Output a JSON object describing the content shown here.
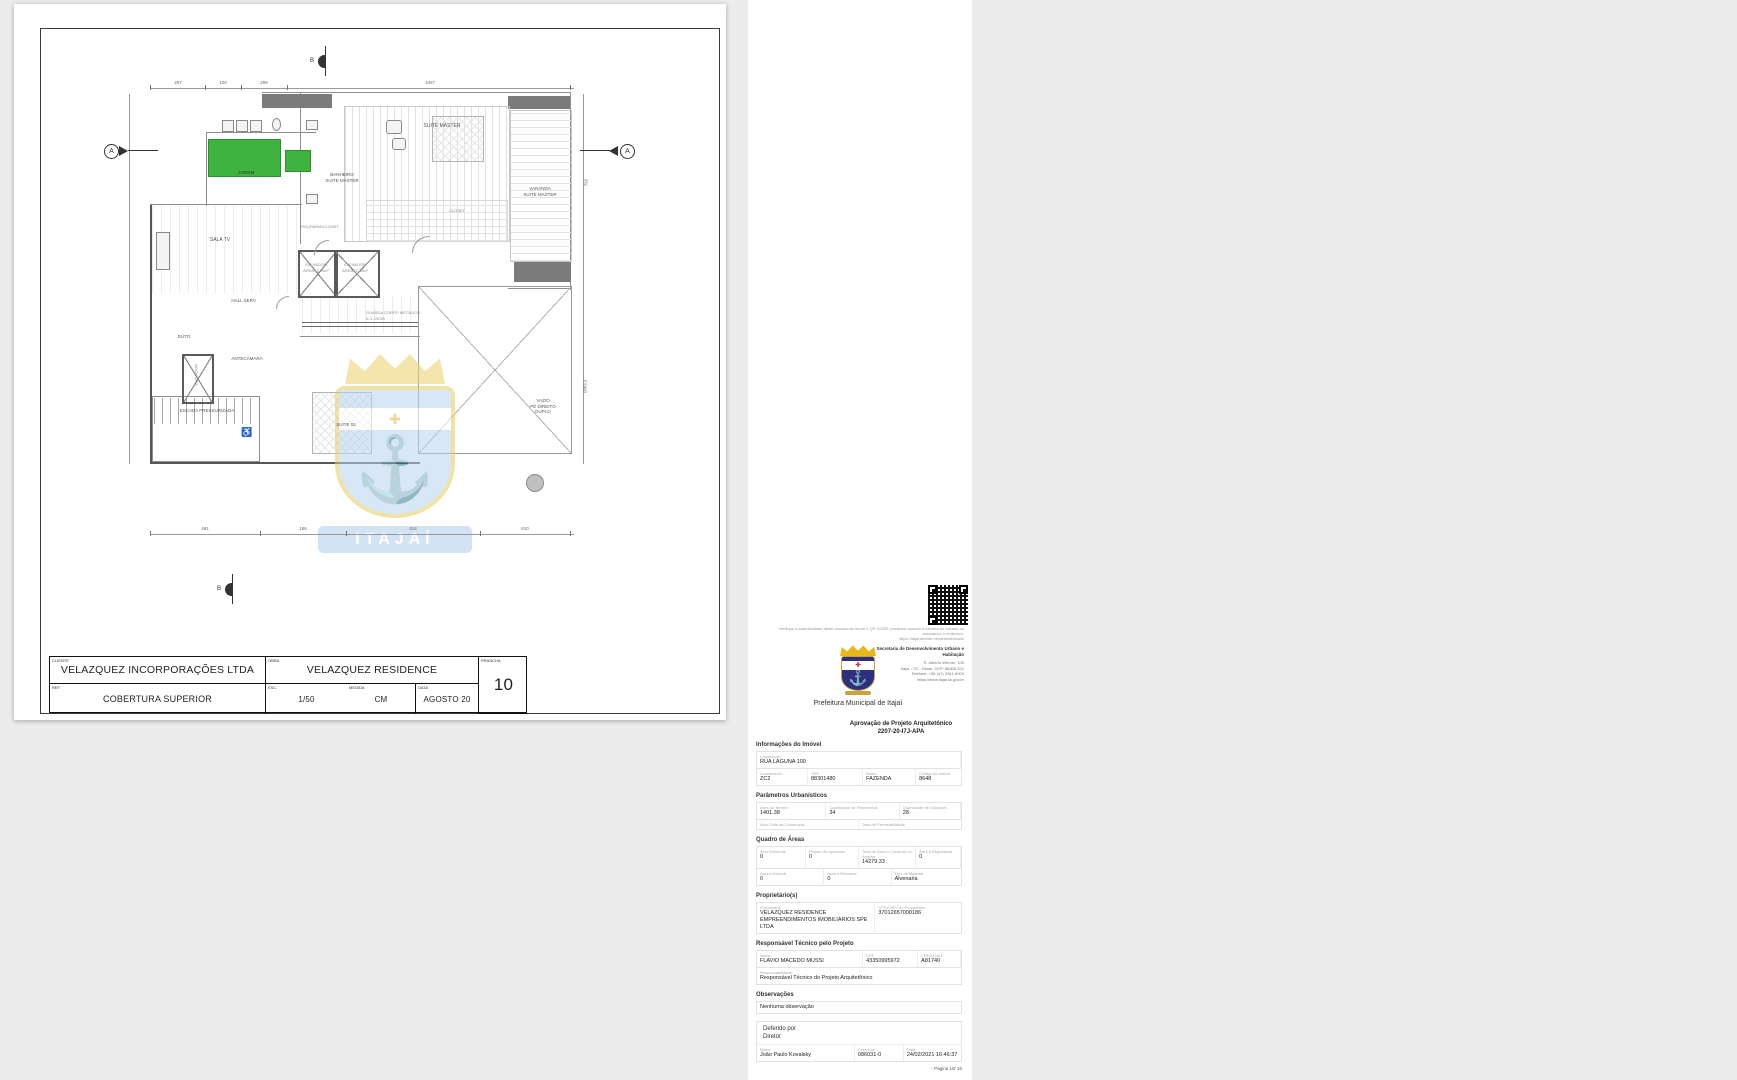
{
  "titleblock": {
    "cliente_label": "CLIENTE",
    "cliente": "VELAZQUEZ INCORPORAÇÕES LTDA",
    "obra_label": "OBRA",
    "obra": "VELAZQUEZ RESIDENCE",
    "ref_label": "REF.",
    "ref": "COBERTURA SUPERIOR",
    "escala_label": "ESC.",
    "escala": "1/50",
    "medida_label": "MEDIDA",
    "medida": "CM",
    "data_label": "DATA",
    "data": "AGOSTO 20",
    "prancha_label": "PRANCHA",
    "prancha": "10"
  },
  "plan": {
    "labels": [
      {
        "text": "SUITE MASTER"
      },
      {
        "text": "VARANDA\nSUITE MASTER"
      },
      {
        "text": "BANHEIRO\nSUITE MASTER"
      },
      {
        "text": "JARDIM"
      },
      {
        "text": "CLOSET"
      },
      {
        "text": "ROUPARIA/CLOSET"
      },
      {
        "text": "SALA TV"
      },
      {
        "text": "ELEVADOR\nÁREA=3,04m²"
      },
      {
        "text": "ELEVADOR\nÁREA=3,36m²"
      },
      {
        "text": "HALL SERV."
      },
      {
        "text": "GUARDA CORPO METÁLICO\nh=1,10CM"
      },
      {
        "text": "DUTO"
      },
      {
        "text": "ANTECÂMARA"
      },
      {
        "text": "ELEVADOR"
      },
      {
        "text": "ESCADA PRESSURIZADA"
      },
      {
        "text": "SUITE 02"
      },
      {
        "text": "VAZIO\nPÉ DIREITO\nDUPLO"
      }
    ],
    "dims_top": [
      "257",
      "120",
      "299",
      "1027"
    ],
    "dims_bottom": [
      "491",
      "186",
      "414",
      "610"
    ],
    "dims_right": [
      "792",
      "1063.3"
    ],
    "section_a": "A",
    "section_b": "B",
    "wheelchair_icon": "♿",
    "watermark_text": "ITAJAÍ",
    "watermark_cross": "✚",
    "anchor_icon": "⚓"
  },
  "stamp": {
    "verify_line1": "Verifique a autenticidade deste documento lendo o QR CODE (escaneie usando a câmera do celular) ou acessando o endereço:",
    "verify_line2": "https://itajai.atende.net/autenticidade",
    "org": {
      "prefeitura": "Prefeitura Municipal de Itajaí",
      "secretaria": "Secretaria de Desenvolvimento Urbano e Habitação",
      "address1": "R. Alberto Werner, 100",
      "address2": "Itajaí - SC - Brasil, CEP: 88305-101",
      "address3": "Telefone: +55 (47) 3341-6000",
      "address4": "https://www.itajai.sc.gov.br",
      "cross": "✚",
      "anchor": "⚓"
    },
    "title": "Aprovação de Projeto Arquitetônico",
    "protocol": "2207-20-I7J-APA",
    "imovel": {
      "header": "Informações do Imóvel",
      "logradouro_label": "Logradouro",
      "logradouro": "RUA LAGUNA 100",
      "zoneamento_label": "Zoneamento",
      "zoneamento": "ZC2",
      "cep_label": "CEP",
      "cep": "88301480",
      "bairro_label": "Bairro",
      "bairro": "FAZENDA",
      "codigo_label": "Código do Imóvel",
      "codigo": "8648"
    },
    "parametros": {
      "header": "Parâmetros Urbanísticos",
      "area_terreno_label": "Área do Terreno",
      "area_terreno": "1401.38",
      "pavimentos_label": "Quantidade de Pavimentos",
      "pavimentos": "34",
      "unidades_label": "Quantidade de Unidades",
      "unidades": "28",
      "area_total_label": "Área Total da Construção",
      "area_total": "",
      "permeabilidade_label": "Taxa de Permeabilidade",
      "permeabilidade": ""
    },
    "quadro": {
      "header": "Quadro de Áreas",
      "existente_label": "Área Existente",
      "existente": "0",
      "aprovado_label": "Projeto de Aprovado",
      "aprovado": "0",
      "construir_label": "Total de Área a Construir ou Ampliar",
      "construir": "14279.33",
      "regularizar_label": "Área a Regularizar",
      "regularizar": "0",
      "demolir_label": "Área a Demolir",
      "demolir": "0",
      "reformar_label": "Área a Reformar",
      "reformar": "0",
      "material_label": "Tipo de Material",
      "material": "Alvenaria"
    },
    "proprietario": {
      "header": "Proprietário(s)",
      "nome_label": "Proprietário",
      "nome": "VELAZQUEZ RESIDENCE EMPREENDIMENTOS IMOBILIARIOS SPE LTDA",
      "cnpj_label": "CPF/CNPJ do Proprietário",
      "cnpj": "37012657000186"
    },
    "responsavel": {
      "header": "Responsável Técnico pelo Projeto",
      "nome_label": "Nome",
      "nome": "FLAVIO MACEDO MUSSI",
      "cpf_label": "CPF",
      "cpf": "43350995972",
      "crea_label": "CREA/CAU",
      "crea": "A81740",
      "resp_label": "Responsabilidade",
      "resp": "Responsável Técnico do Projeto Arquitetônico"
    },
    "observacoes": {
      "header": "Observações",
      "texto": "Nenhuma observação"
    },
    "deferido": {
      "header": "Deferido por",
      "cargo": "Diretor",
      "nome_label": "Nome",
      "nome": "João Paulo Kovalsky",
      "crea_label": "Crea/Cau",
      "crea": "086031-0",
      "data_label": "Data",
      "data": "24/02/2021 16:46:37"
    },
    "footer": "- Página 10/ 16"
  }
}
